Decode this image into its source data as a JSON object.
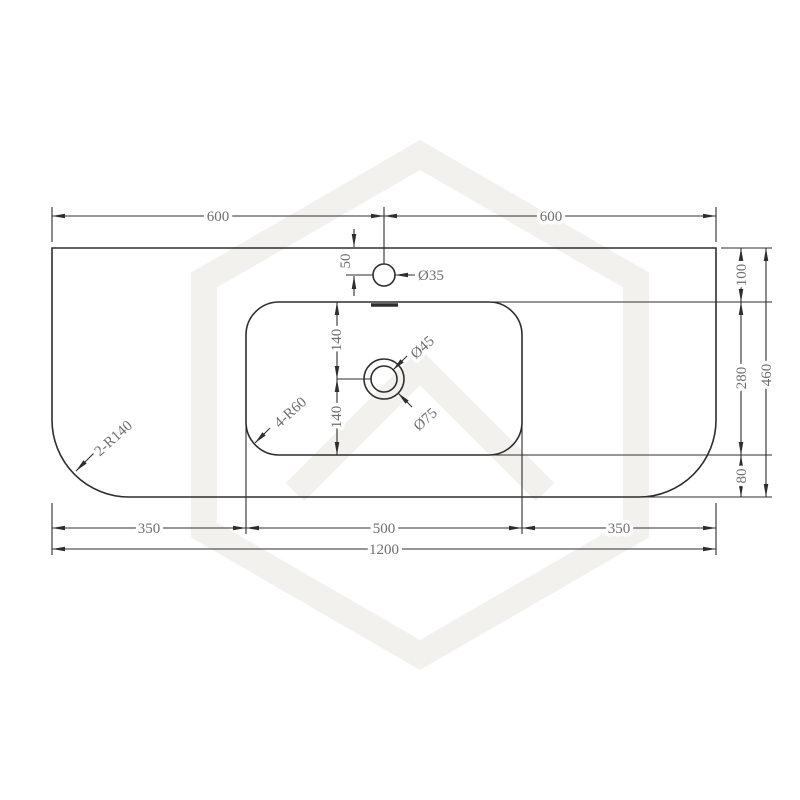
{
  "colors": {
    "line": "#2e2e2e",
    "dimension_text": "#6e6e6e",
    "watermark": "#f2f1ee",
    "background": "#ffffff"
  },
  "dimensions": {
    "top_left": "600",
    "top_right": "600",
    "tap_hole_offset": "50",
    "basin_top_to_drain": "140",
    "drain_to_basin_bottom": "140",
    "right_top": "100",
    "right_middle": "280",
    "right_bottom": "80",
    "right_overall": "460",
    "bottom_left": "350",
    "bottom_center": "500",
    "bottom_right": "350",
    "bottom_overall": "1200"
  },
  "callouts": {
    "tap_hole_diameter": "Ø35",
    "drain_top_diameter": "Ø45",
    "drain_outer_diameter": "Ø75",
    "counter_corner_radius": "2-R140",
    "basin_corner_radius": "4-R60"
  }
}
